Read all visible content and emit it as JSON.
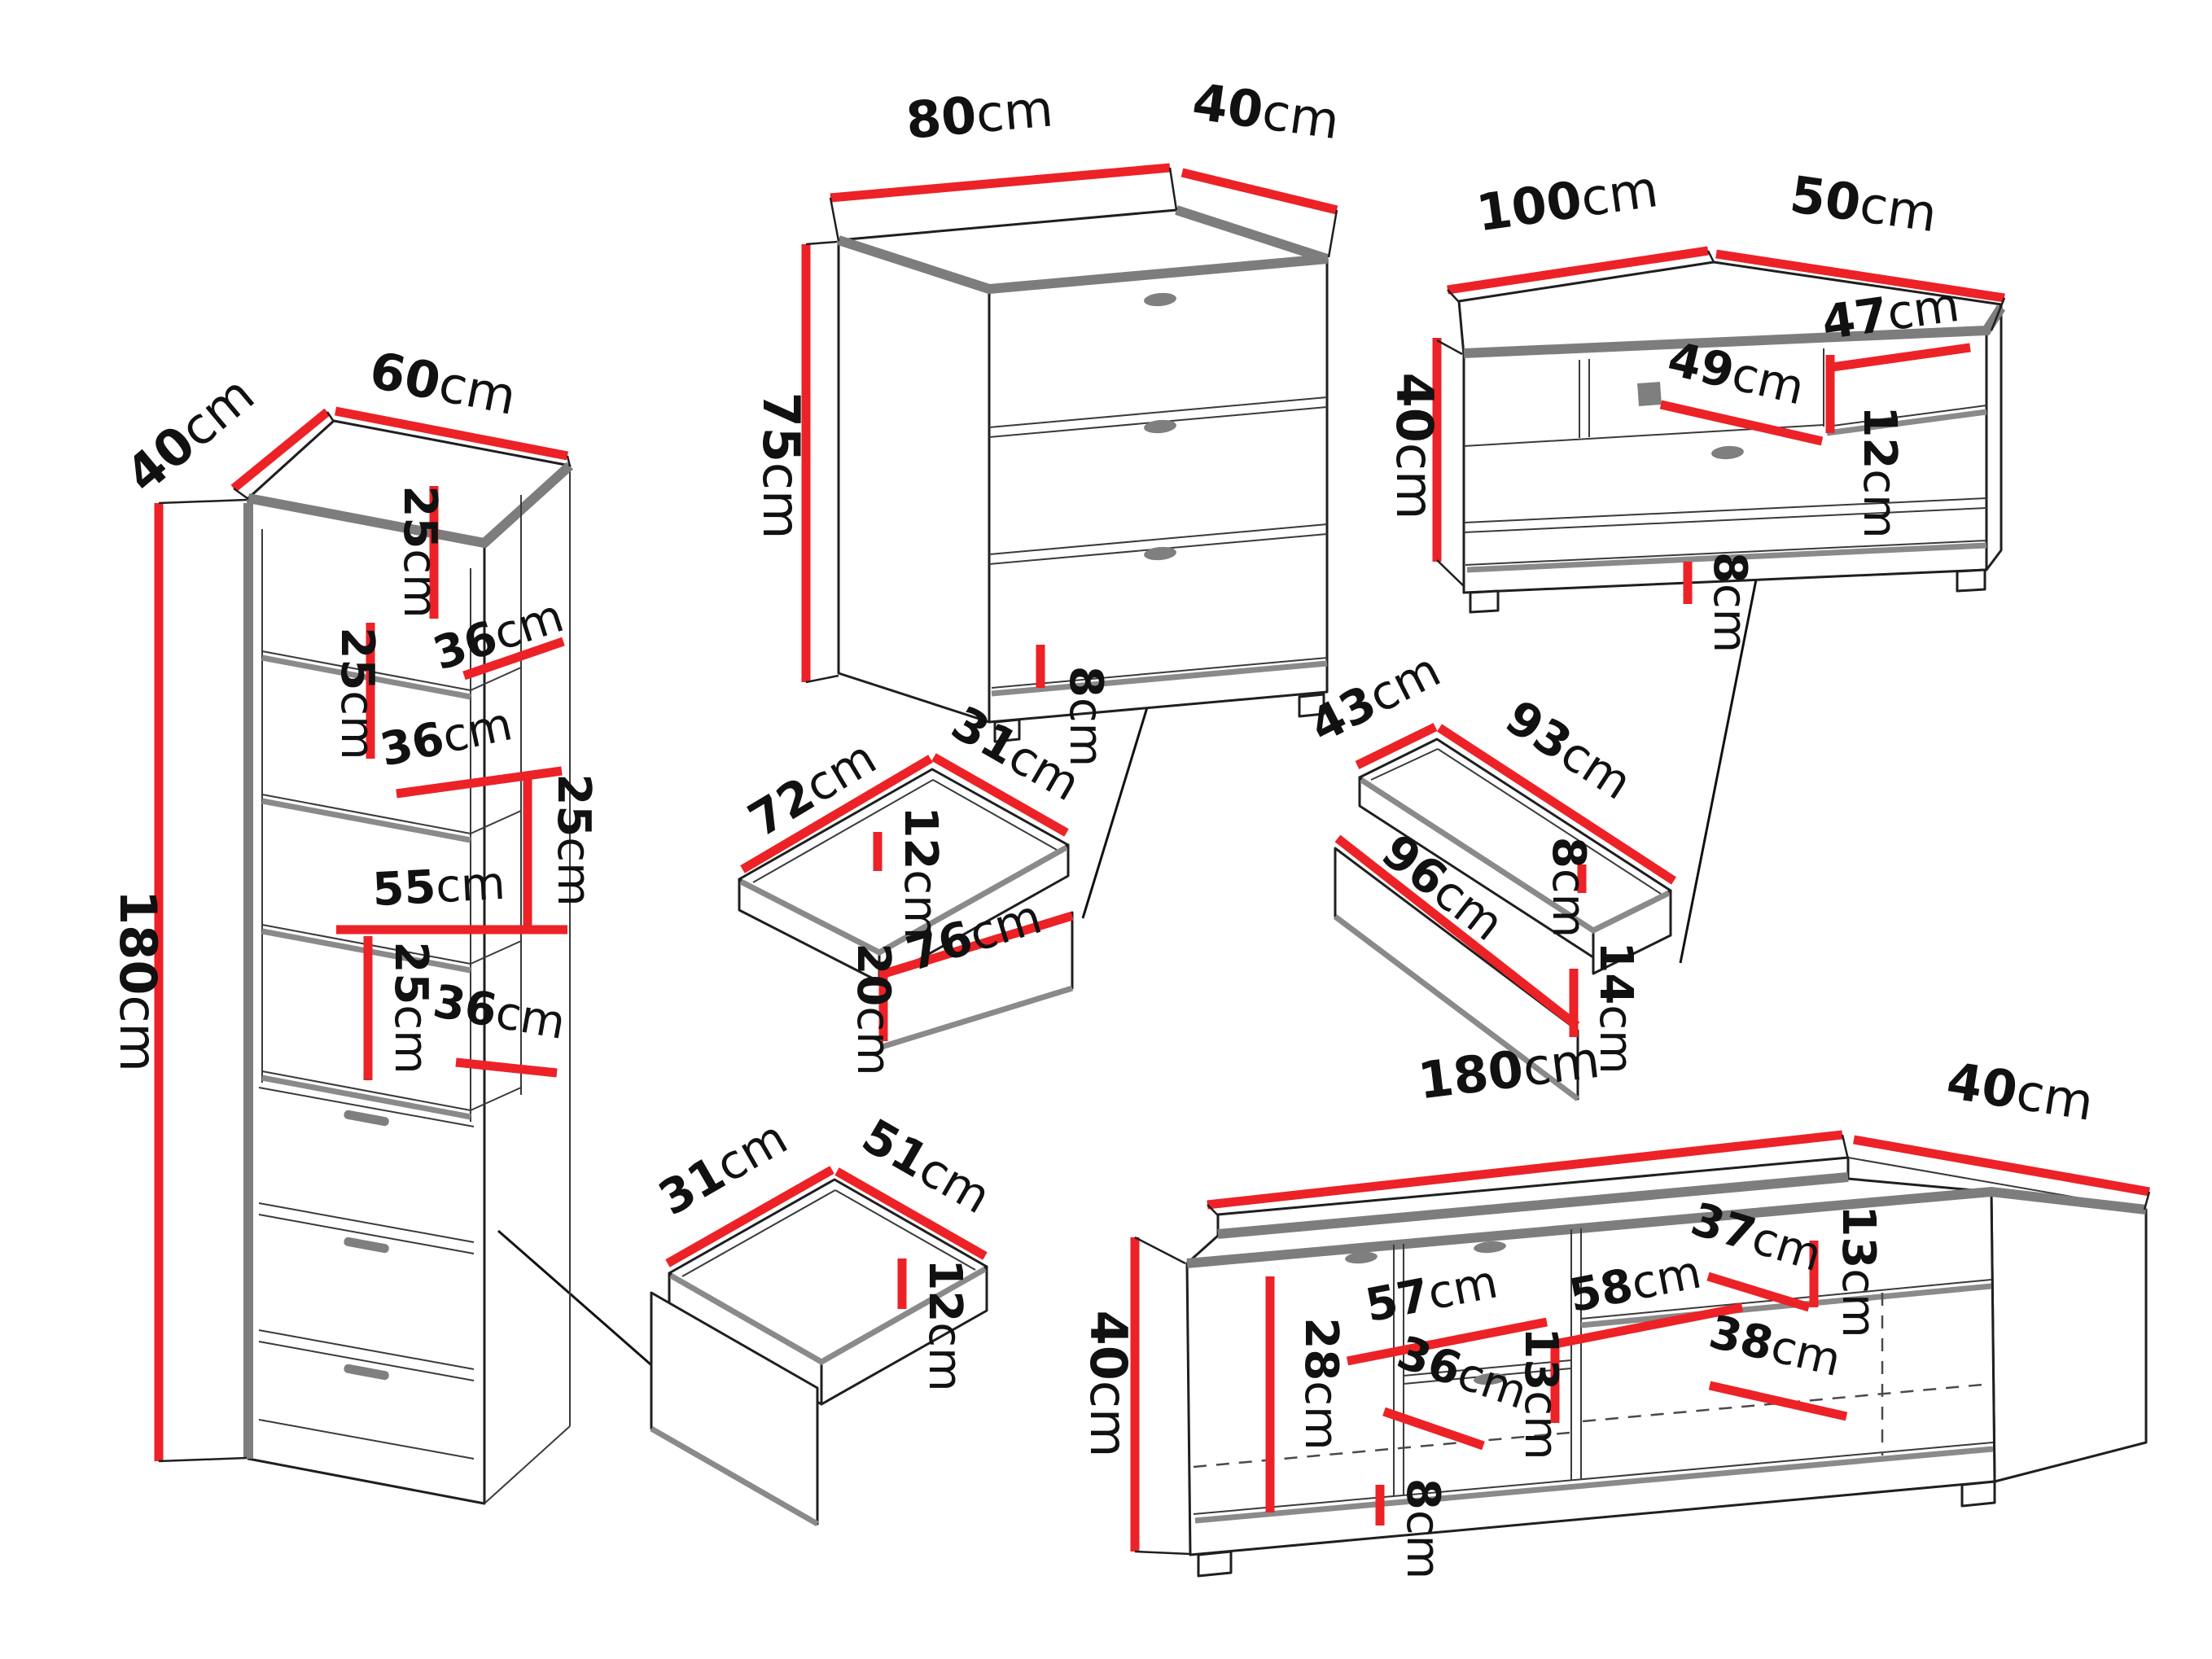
{
  "diagram": "furniture dimensions line drawing",
  "colors": {
    "dimension_line": "#ec2227",
    "outline": "#1f1f1f",
    "shadow_edge": "#7d7d7d",
    "label_text": "#111111",
    "background": "#ffffff"
  },
  "pieces": {
    "bookcase": {
      "title": "tall bookcase",
      "labels": {
        "depth": {
          "num": "40",
          "unit": "cm"
        },
        "width": {
          "num": "60",
          "unit": "cm"
        },
        "height": {
          "num": "180",
          "unit": "cm"
        },
        "compartment1_height": {
          "num": "25",
          "unit": "cm"
        },
        "shelf1_width": {
          "num": "36",
          "unit": "cm"
        },
        "compartment2_height": {
          "num": "25",
          "unit": "cm"
        },
        "shelf2_width": {
          "num": "36",
          "unit": "cm"
        },
        "compartment3_height": {
          "num": "25",
          "unit": "cm"
        },
        "shelf3_width": {
          "num": "55",
          "unit": "cm"
        },
        "compartment4_height": {
          "num": "25",
          "unit": "cm"
        },
        "shelf4_width": {
          "num": "36",
          "unit": "cm"
        }
      }
    },
    "chest": {
      "title": "chest of drawers",
      "labels": {
        "width": {
          "num": "80",
          "unit": "cm"
        },
        "depth": {
          "num": "40",
          "unit": "cm"
        },
        "height": {
          "num": "75",
          "unit": "cm"
        },
        "plinth_height": {
          "num": "8",
          "unit": "cm"
        }
      }
    },
    "chest_drawer": {
      "title": "chest drawer box",
      "labels": {
        "width": {
          "num": "72",
          "unit": "cm"
        },
        "depth": {
          "num": "31",
          "unit": "cm"
        },
        "inner_height": {
          "num": "12",
          "unit": "cm"
        },
        "front_width": {
          "num": "76",
          "unit": "cm"
        },
        "front_height": {
          "num": "20",
          "unit": "cm"
        }
      }
    },
    "tv_cabinet": {
      "title": "tv cabinet",
      "labels": {
        "width": {
          "num": "100",
          "unit": "cm"
        },
        "depth": {
          "num": "50",
          "unit": "cm"
        },
        "height": {
          "num": "40",
          "unit": "cm"
        },
        "niche_width": {
          "num": "47",
          "unit": "cm"
        },
        "drawer_width": {
          "num": "49",
          "unit": "cm"
        },
        "niche_height": {
          "num": "12",
          "unit": "cm"
        },
        "plinth_height": {
          "num": "8",
          "unit": "cm"
        }
      }
    },
    "tv_cabinet_drawer": {
      "title": "tv cabinet drawer box",
      "labels": {
        "depth": {
          "num": "43",
          "unit": "cm"
        },
        "width": {
          "num": "93",
          "unit": "cm"
        },
        "front_width": {
          "num": "96",
          "unit": "cm"
        },
        "back_height": {
          "num": "8",
          "unit": "cm"
        },
        "front_height": {
          "num": "14",
          "unit": "cm"
        }
      }
    },
    "bookcase_drawer": {
      "title": "bookcase drawer box",
      "labels": {
        "depth": {
          "num": "31",
          "unit": "cm"
        },
        "width": {
          "num": "51",
          "unit": "cm"
        },
        "inner_height": {
          "num": "12",
          "unit": "cm"
        }
      }
    },
    "tv_stand": {
      "title": "long tv stand",
      "labels": {
        "width": {
          "num": "180",
          "unit": "cm"
        },
        "depth": {
          "num": "40",
          "unit": "cm"
        },
        "height": {
          "num": "40",
          "unit": "cm"
        },
        "inner_height": {
          "num": "28",
          "unit": "cm"
        },
        "section1_width": {
          "num": "57",
          "unit": "cm"
        },
        "section2_width": {
          "num": "58",
          "unit": "cm"
        },
        "section3_width": {
          "num": "37",
          "unit": "cm"
        },
        "right_section_height": {
          "num": "13",
          "unit": "cm"
        },
        "shelf_width": {
          "num": "38",
          "unit": "cm"
        },
        "drawer_width": {
          "num": "36",
          "unit": "cm"
        },
        "plinth_height": {
          "num": "8",
          "unit": "cm"
        },
        "middle_height": {
          "num": "13",
          "unit": "cm"
        }
      }
    }
  }
}
